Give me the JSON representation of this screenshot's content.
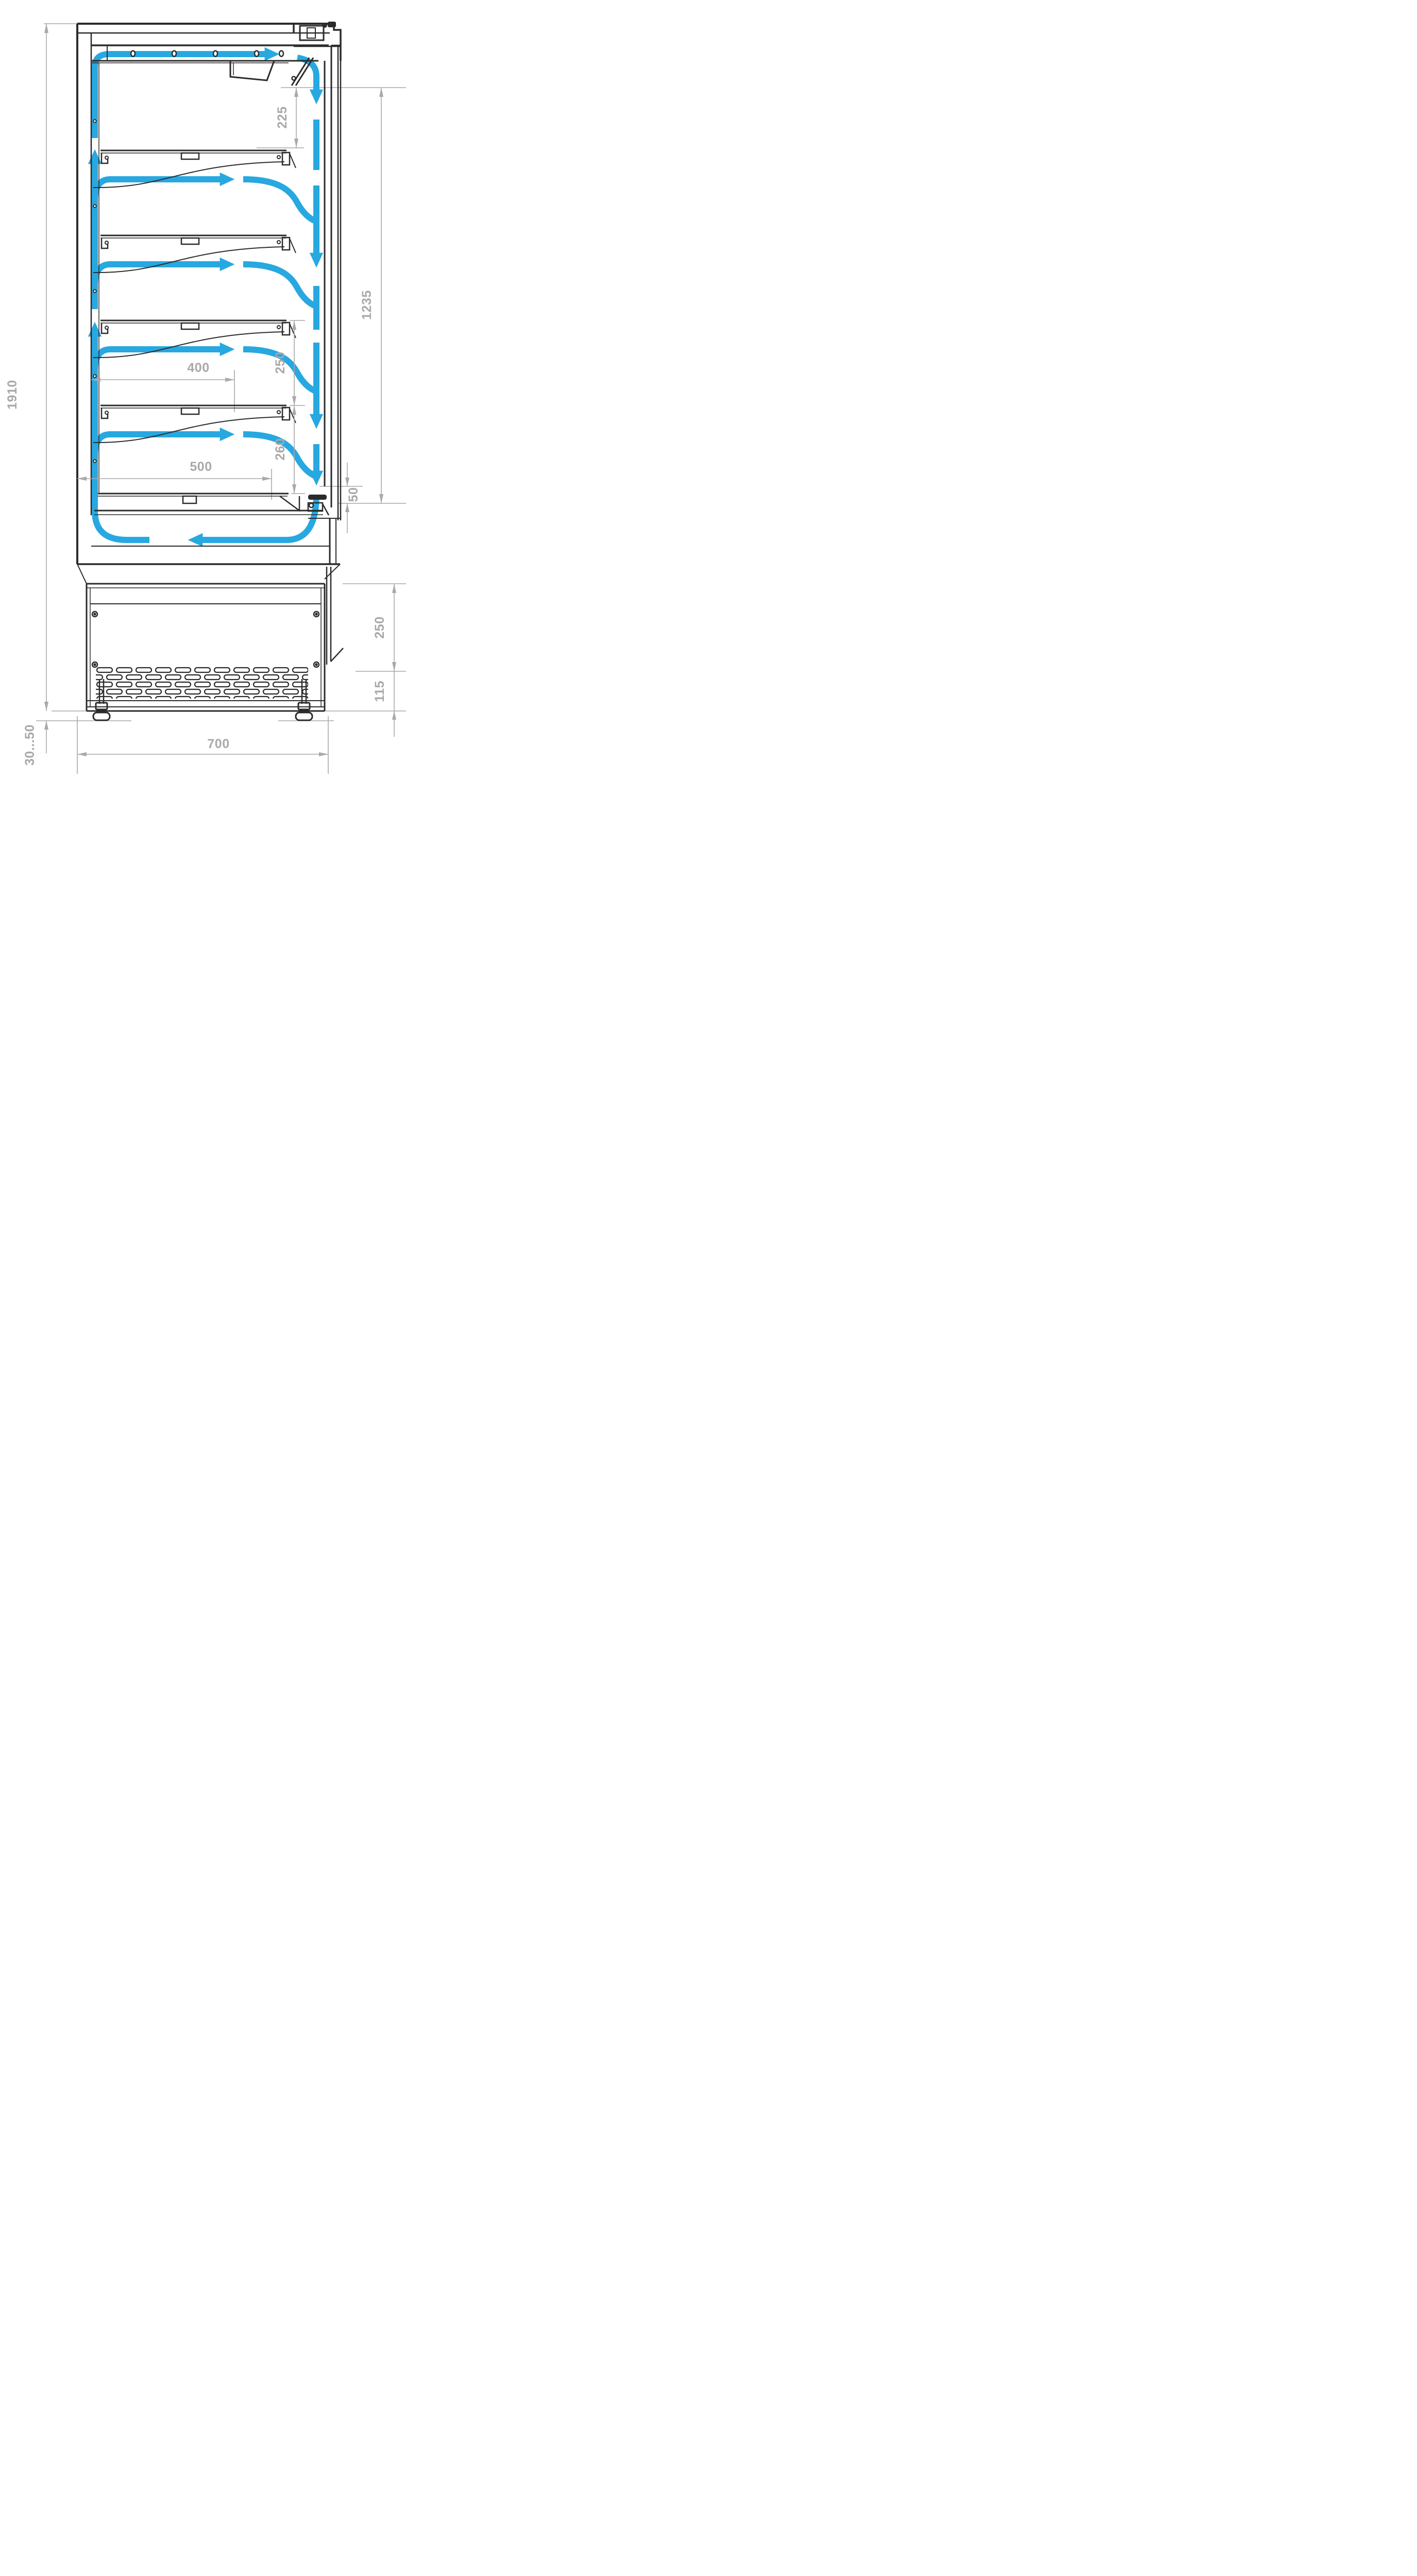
{
  "diagram": {
    "title": "refrigerated-display-cabinet-airflow-cross-section",
    "colors": {
      "line": "#2b2b2b",
      "dimension_gray": "#a9a9a9",
      "airflow_blue": "#27a8e0",
      "background": "#ffffff"
    },
    "dimensions": {
      "overall_height": "1910",
      "foot_adjust_range": "30...50",
      "depth": "700",
      "top_air_gap": "225",
      "air_curtain_height": "1235",
      "bottom_outlet_gap": "50",
      "base_height": "250",
      "grille_height": "115",
      "shelf_depth": "400",
      "shelf_spacing": "250",
      "deck_spacing": "260",
      "deck_depth": "500"
    },
    "airflow": {
      "arrows": [
        "airflow-top-right-arrow",
        "airflow-duct-up-arrow-lower",
        "airflow-duct-up-arrow-upper",
        "airflow-shelf-arrow-1",
        "airflow-shelf-arrow-2",
        "airflow-shelf-arrow-3",
        "airflow-shelf-arrow-4",
        "airflow-curtain-down-arrow-1",
        "airflow-curtain-down-arrow-2",
        "airflow-curtain-down-arrow-3",
        "airflow-curtain-down-arrow-4",
        "airflow-return-left-arrow"
      ]
    }
  }
}
